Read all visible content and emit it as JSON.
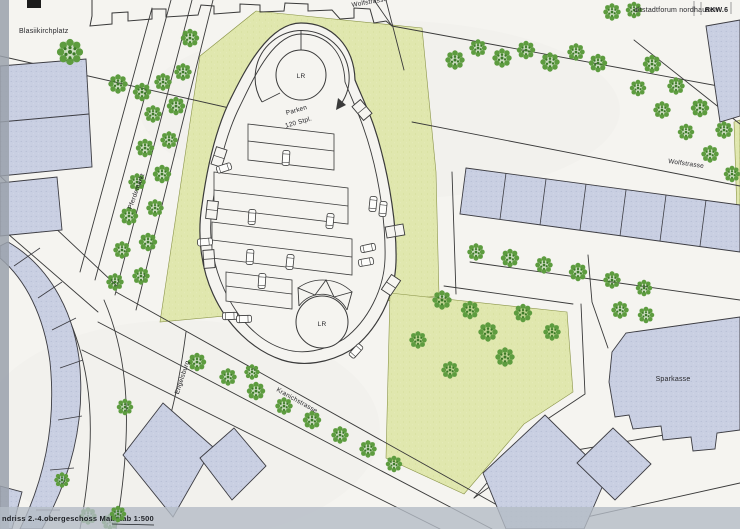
{
  "document": {
    "title_block": {
      "project": "altstadtforum nordhausen",
      "sheet_no": "RKW.6"
    },
    "caption": "ndriss 2.-4.obergeschoss Maßstab 1:500"
  },
  "labels": {
    "blasiikirchplatz": "Blasiikirchplatz",
    "wolfstrasse_top": "Wolfstrasse",
    "wolfstrasse_right": "Wolfstrasse",
    "pferdemarkt": "Pferdemarkt",
    "kranichstrasse": "Kranichstrasse",
    "engelsburg": "Engelsburg",
    "sparkasse": "Sparkasse",
    "parken": "Parken",
    "parken_capacity": "120 Stpl.",
    "ramp_top": "LR",
    "ramp_bottom": "LR"
  },
  "colors": {
    "paper": "#f5f4f0",
    "line": "#3a3a3a",
    "building": "#c9cfe2",
    "building-edge": "#3c3c42",
    "green": "#e0e7ae",
    "green-edge": "#8a9448",
    "tree": "#5d9c3f",
    "tree-dark": "#3c7a28",
    "scan-left": "#9aa1ac",
    "scan-bottom": "#b4bbc6",
    "text": "#26262a"
  }
}
